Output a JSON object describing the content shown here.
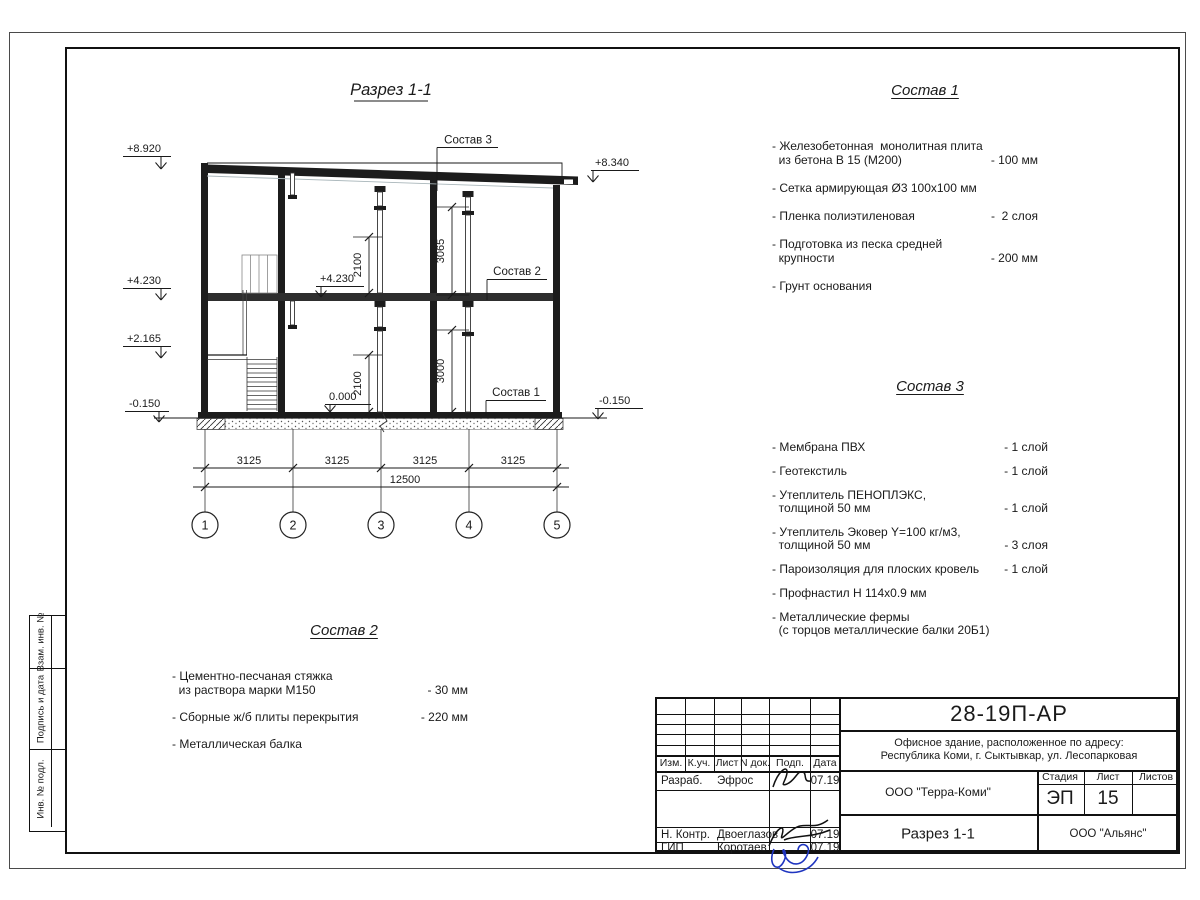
{
  "drawing": {
    "title": "Разрез 1-1",
    "elevations": {
      "top_left": "+8.920",
      "top_right": "+8.340",
      "mid_left": "+4.230",
      "mid_inner": "+4.230",
      "landing": "+2.165",
      "ground_left": "-0.150",
      "ground_right": "-0.150",
      "zero": "0.000"
    },
    "vdims": {
      "floor2_opening": "2100",
      "floor2_clear": "3065",
      "floor1_opening": "2100",
      "floor1_clear": "3000"
    },
    "bays": [
      "3125",
      "3125",
      "3125",
      "3125"
    ],
    "total_span": "12500",
    "axes": [
      "1",
      "2",
      "3",
      "4",
      "5"
    ],
    "leaders": {
      "sostav3": "Состав 3",
      "sostav2": "Состав 2",
      "sostav1": "Состав 1"
    }
  },
  "spec1": {
    "title": "Состав 1",
    "items": [
      {
        "lines": [
          "- Железобетонная  монолитная плита",
          "  из бетона В 15 (М200)"
        ],
        "value": "- 100 мм"
      },
      {
        "lines": [
          "- Сетка армирующая Ø3 100х100 мм"
        ],
        "value": ""
      },
      {
        "lines": [
          "- Пленка полиэтиленовая"
        ],
        "value": "-  2 слоя"
      },
      {
        "lines": [
          "- Подготовка из песка средней",
          "  крупности"
        ],
        "value": "- 200 мм"
      },
      {
        "lines": [
          "- Грунт основания"
        ],
        "value": ""
      }
    ]
  },
  "spec2": {
    "title": "Состав 2",
    "items": [
      {
        "lines": [
          "- Цементно-песчаная стяжка",
          "  из раствора марки М150"
        ],
        "value": "- 30 мм"
      },
      {
        "lines": [
          "- Сборные ж/б плиты перекрытия"
        ],
        "value": "- 220 мм"
      },
      {
        "lines": [
          "- Металлическая балка"
        ],
        "value": ""
      }
    ]
  },
  "spec3": {
    "title": "Состав 3",
    "items": [
      {
        "lines": [
          "- Мембрана ПВХ"
        ],
        "value": "- 1 слой"
      },
      {
        "lines": [
          "- Геотекстиль"
        ],
        "value": "- 1 слой"
      },
      {
        "lines": [
          "- Утеплитель ПЕНОПЛЭКС,",
          "  толщиной 50 мм"
        ],
        "value": "- 1 слой"
      },
      {
        "lines": [
          "- Утеплитель Эковер Y=100 кг/м3,",
          "  толщиной 50 мм"
        ],
        "value": "- 3 слоя"
      },
      {
        "lines": [
          "- Пароизоляция для плоских кровель"
        ],
        "value": "- 1 слой"
      },
      {
        "lines": [
          "- Профнастил Н 114х0.9 мм"
        ],
        "value": ""
      },
      {
        "lines": [
          "- Металлические фермы",
          "  (с торцов металлические балки 20Б1)"
        ],
        "value": ""
      }
    ]
  },
  "side_strips": [
    "Взам. инв. №",
    "Подпись и дата",
    "Инв. № подл."
  ],
  "titleblock": {
    "doc_code": "28-19П-АР",
    "object_line1": "Офисное здание, расположенное по адресу:",
    "object_line2": "Республика Коми, г. Сыктывкар, ул. Лесопарковая",
    "header": {
      "izm": "Изм.",
      "kuch": "К.уч.",
      "list": "Лист",
      "ndok": "N док.",
      "podp": "Подп.",
      "data": "Дата"
    },
    "rows": [
      {
        "role": "Разраб.",
        "name": "Эфрос",
        "date": "07.19"
      },
      {
        "role": "Н. Контр.",
        "name": "Двоеглазов",
        "date": "07.19"
      },
      {
        "role": "ГИП",
        "name": "Коротаев",
        "date": "07.19"
      }
    ],
    "org_center": "ООО \"Терра-Коми\"",
    "stage_label": "Стадия",
    "sheet_label": "Лист",
    "sheets_label": "Листов",
    "stage": "ЭП",
    "sheet_no": "15",
    "sheet_title": "Разрез 1-1",
    "org_right": "ООО \"Альянс\"",
    "signature_color": "#1f35c0"
  }
}
